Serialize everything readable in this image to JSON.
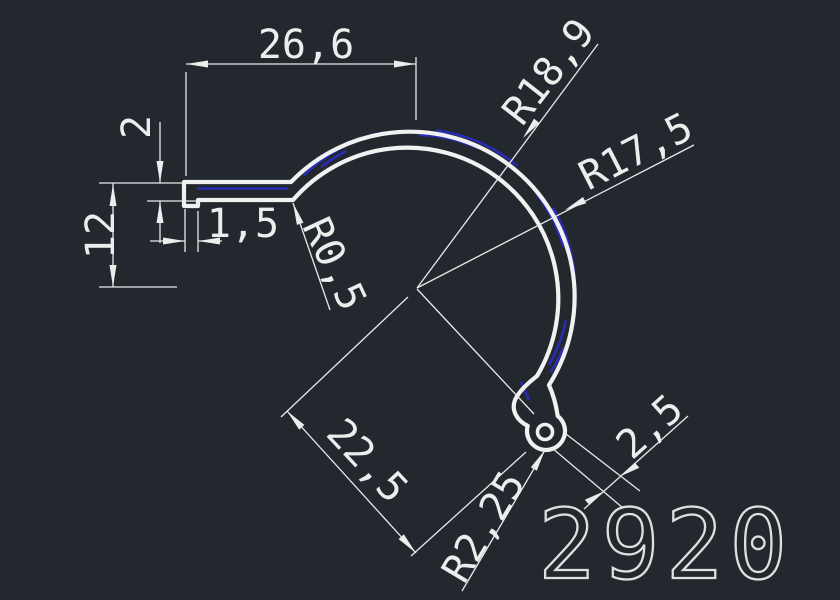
{
  "drawing": {
    "part_number": "2920",
    "labels": {
      "width_top": "26,6",
      "thickness": "2",
      "height_left": "12",
      "lip": "1,5",
      "fillet": "R0,5",
      "radius_outer": "R18,9",
      "radius_inner": "R17,5",
      "length_diag": "22,5",
      "bead_radius": "R2,25",
      "bead_gap": "2,5"
    },
    "colors": {
      "background": "#23272e",
      "geometry": "#f1f1f1",
      "accent_blue": "#272cb3",
      "dimension": "#e9e9e9"
    }
  }
}
